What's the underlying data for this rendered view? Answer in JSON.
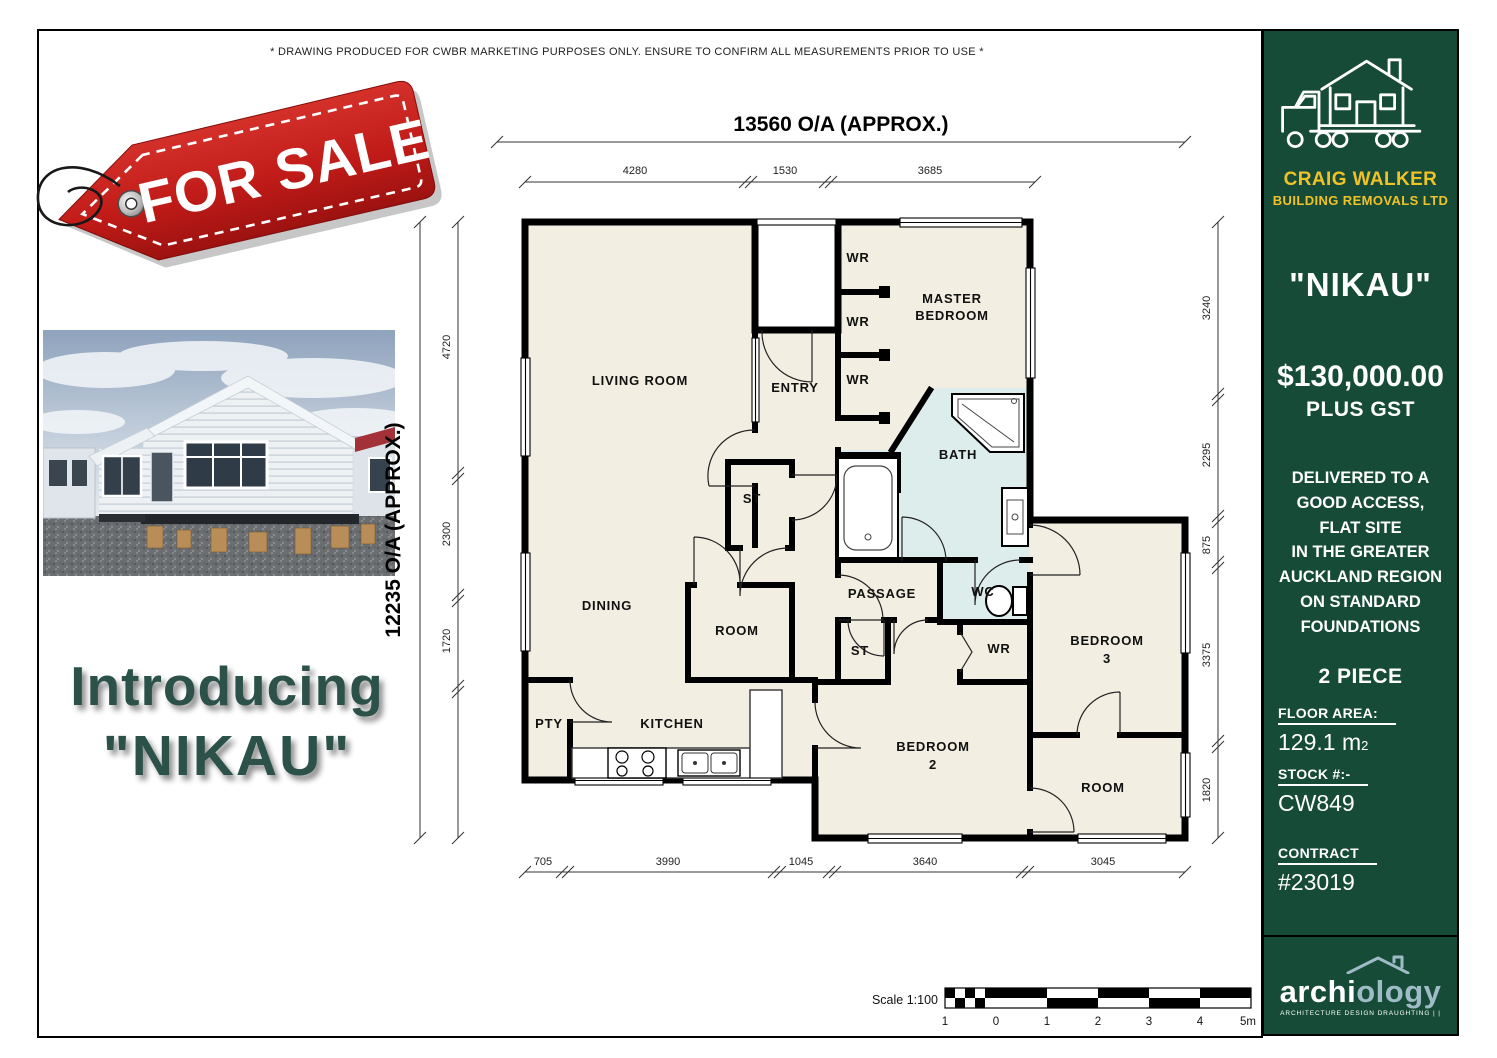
{
  "page": {
    "disclaimer": "* DRAWING PRODUCED FOR CWBR MARKETING PURPOSES ONLY. ENSURE TO CONFIRM ALL MEASUREMENTS PRIOR TO USE *"
  },
  "tag": {
    "label": "FOR SALE"
  },
  "intro": {
    "line1": "Introducing",
    "line2": "\"NIKAU\""
  },
  "plan": {
    "dim_top_overall": "13560 O/A (APPROX.)",
    "dim_left_overall": "12235 O/A (APPROX.)",
    "top_dims": [
      "4280",
      "1530",
      "3685"
    ],
    "bottom_dims": [
      "705",
      "3990",
      "1045",
      "3640",
      "3045"
    ],
    "right_dims": [
      "3240",
      "2295",
      "875",
      "3375",
      "1820"
    ],
    "left_dims": [
      "4720",
      "2300",
      "1720"
    ],
    "rooms": {
      "living": "LIVING ROOM",
      "entry": "ENTRY",
      "wr": "WR",
      "master1": "MASTER",
      "master2": "BEDROOM",
      "bath": "BATH",
      "wc": "WC",
      "st": "ST",
      "dining": "DINING",
      "room": "ROOM",
      "passage": "PASSAGE",
      "pty": "PTY",
      "kitchen": "KITCHEN",
      "bed2a": "BEDROOM",
      "bed2b": "2",
      "bed3a": "BEDROOM",
      "bed3b": "3"
    },
    "scale": {
      "label": "Scale 1:100",
      "ticks": [
        "1",
        "0",
        "1",
        "2",
        "3",
        "4",
        "5m"
      ]
    }
  },
  "sidebar": {
    "brand_name": "CRAIG WALKER",
    "brand_sub": "BUILDING REMOVALS LTD",
    "model": "\"NIKAU\"",
    "price": "$130,000.00",
    "price_sub": "PLUS GST",
    "delivery": "DELIVERED TO A\nGOOD ACCESS,\nFLAT SITE\nIN THE GREATER\nAUCKLAND REGION\nON STANDARD\nFOUNDATIONS",
    "pieces": "2 PIECE",
    "floor_area_label": "FLOOR AREA:",
    "floor_area_value": "129.1 m",
    "floor_area_sup": "2",
    "stock_label": "STOCK #:-",
    "stock_value": "CW849",
    "contract_label": "CONTRACT",
    "contract_value": "#23019",
    "archio_part1": "archi",
    "archio_part2": "ology",
    "archio_tagline": "ARCHITECTURE DESIGN DRAUGHTING |  |"
  },
  "colors": {
    "sidebar_green": "#164B38",
    "brand_yellow": "#EFC327",
    "tag_red": "#C4201D",
    "intro_green": "#2B5149",
    "floor_cream": "#F2EEE1",
    "bath_blue": "#DCEDEB",
    "archio_blue": "#9FBCC6"
  }
}
